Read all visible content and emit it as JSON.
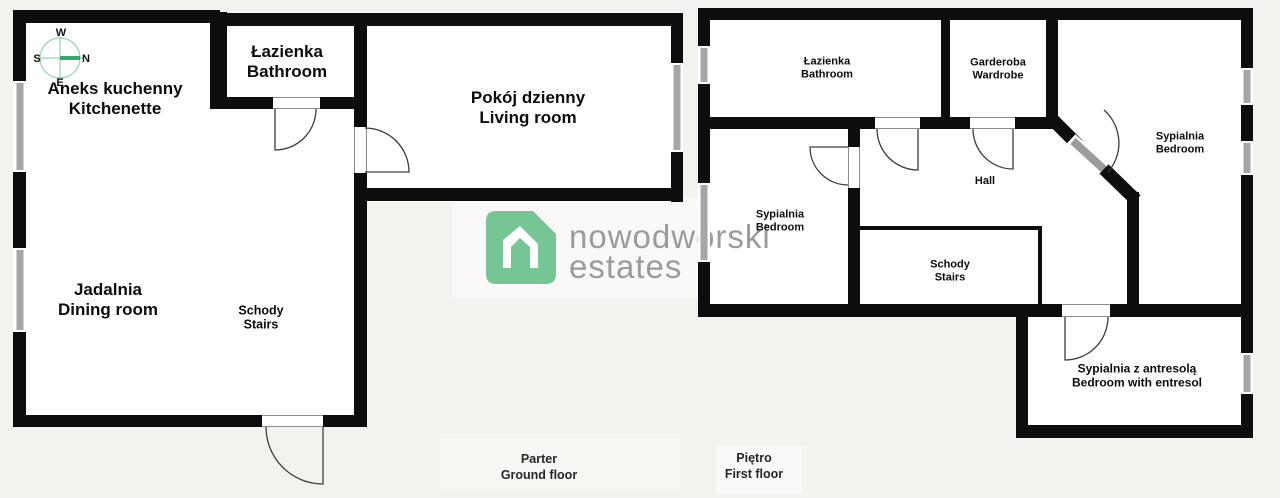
{
  "logo": {
    "line1": "nowodworski",
    "line2": "estates"
  },
  "compass": {
    "west": "W",
    "south": "S",
    "north": "N",
    "east": "E"
  },
  "ground_floor": {
    "caption": {
      "pl": "Parter",
      "en": "Ground floor"
    },
    "rooms": [
      {
        "id": "kitchenette",
        "pl": "Aneks kuchenny",
        "en": "Kitchenette"
      },
      {
        "id": "bathroom",
        "pl": "Łazienka",
        "en": "Bathroom"
      },
      {
        "id": "living-room",
        "pl": "Pokój dzienny",
        "en": "Living room"
      },
      {
        "id": "dining-room",
        "pl": "Jadalnia",
        "en": "Dining room"
      },
      {
        "id": "stairs",
        "pl": "Schody",
        "en": "Stairs"
      }
    ]
  },
  "first_floor": {
    "caption": {
      "pl": "Piętro",
      "en": "First floor"
    },
    "rooms": [
      {
        "id": "bathroom",
        "pl": "Łazienka",
        "en": "Bathroom"
      },
      {
        "id": "wardrobe",
        "pl": "Garderoba",
        "en": "Wardrobe"
      },
      {
        "id": "hall",
        "pl": "Hall",
        "en": ""
      },
      {
        "id": "bedroom-left",
        "pl": "Sypialnia",
        "en": "Bedroom"
      },
      {
        "id": "bedroom-right",
        "pl": "Sypialnia",
        "en": "Bedroom"
      },
      {
        "id": "stairs",
        "pl": "Schody",
        "en": "Stairs"
      },
      {
        "id": "bedroom-entresol",
        "pl": "Sypialnia z antresolą",
        "en": "Bedroom with entresol"
      }
    ]
  },
  "palette": {
    "wall": "#0d0d0d",
    "window_glass": "#a6a6a6",
    "door_arc": "#3c3c3c",
    "door_leaf_gray": "#9c9c9c",
    "background": "#f3f2ef",
    "room": "#ffffff",
    "logo_green": "#75c694",
    "logo_gray": "#9b9b99",
    "compass_green": "#96d4b0",
    "compass_needle": "#2fa96d"
  }
}
